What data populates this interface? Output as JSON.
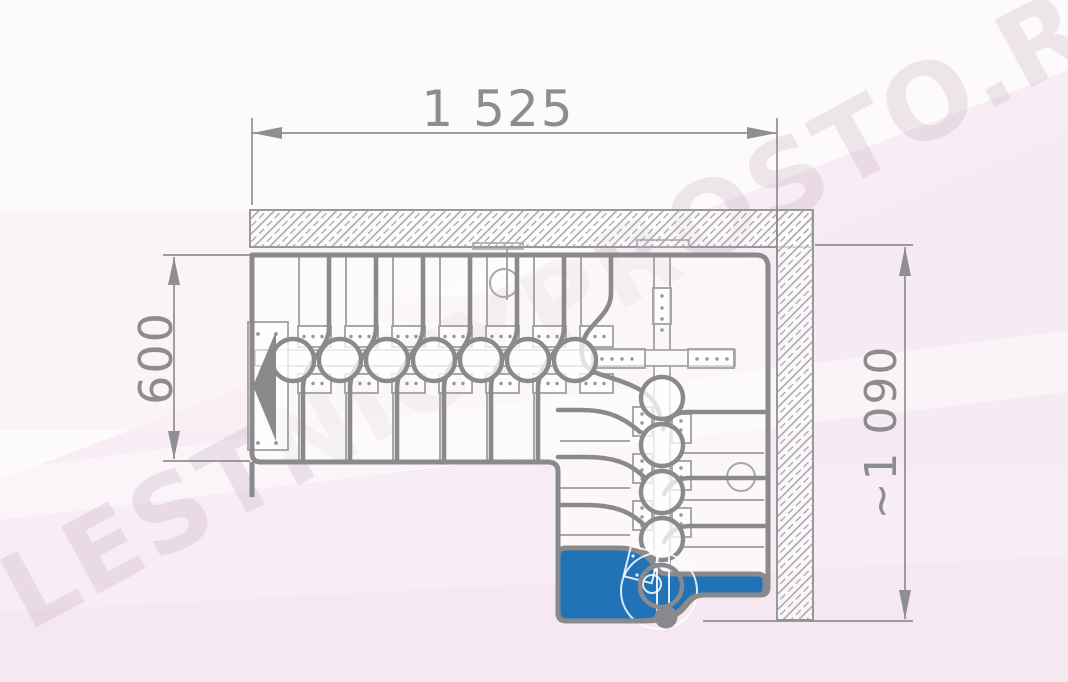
{
  "drawing": {
    "kind": "staircase-plan-top-view",
    "watermark": {
      "text": "LESTNICYPROSTO.RU"
    },
    "dimensions": {
      "top": {
        "label": "1 525"
      },
      "left": {
        "label": "600"
      },
      "right": {
        "label": "~1 090"
      }
    },
    "plan": {
      "straight_flight_modules": 7,
      "turn_flight_modules": 5,
      "walls": [
        "top",
        "right"
      ]
    },
    "colors": {
      "first_step_blue": "#2173b7",
      "line_gray": "#8a8a8d",
      "thin_line_gray": "#a8a8ab",
      "hatch_gray": "#9da0a3",
      "dimension_gray": "#8d8d90",
      "background": "#fdfafc",
      "pink_tint": "#f6eaf1",
      "watermark_tint": "rgba(168,132,156,0.18)"
    }
  }
}
